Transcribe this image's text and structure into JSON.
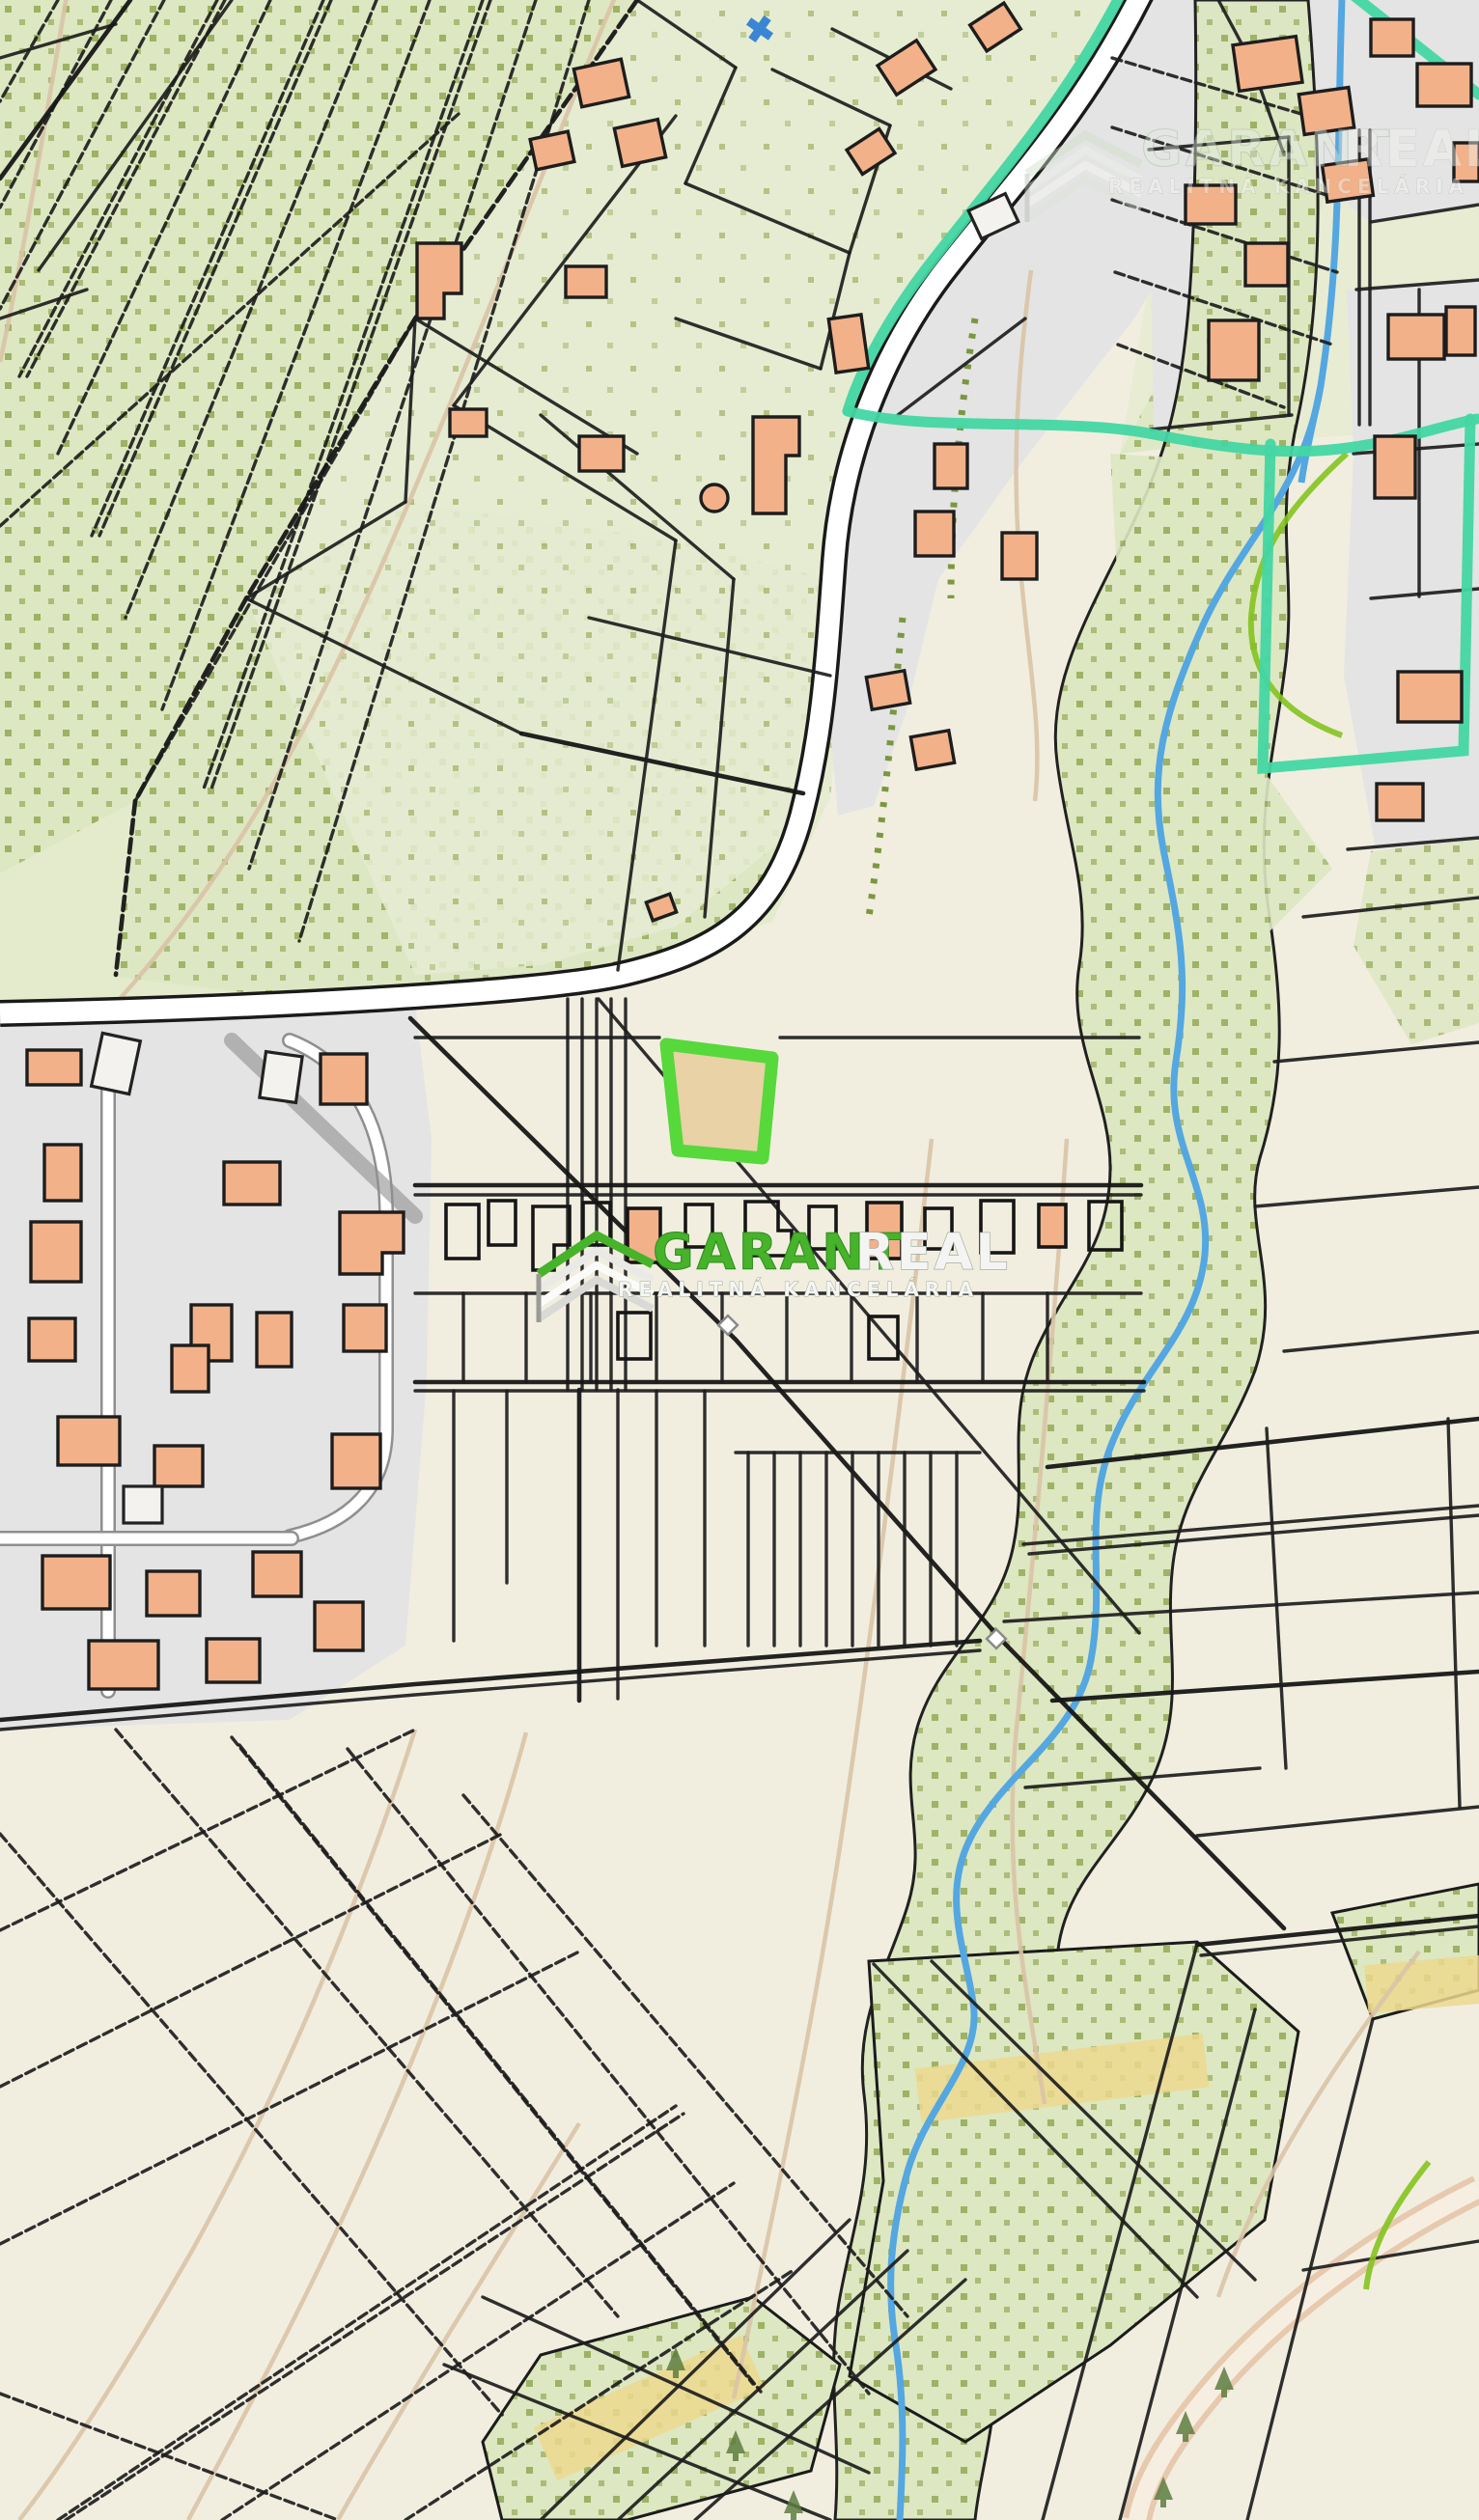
{
  "app": {
    "title": "Cadastral map with highlighted land parcel"
  },
  "watermarks": {
    "center": {
      "brand_primary": "GARANT",
      "brand_secondary": "REAL",
      "tagline": "REALITNÁ KANCELÁRIA"
    },
    "corner": {
      "brand_primary": "GARANT",
      "brand_secondary": "REAL",
      "tagline": "REALITNÁ KANCELÁRIA"
    }
  },
  "highlighted_parcel": {
    "description": "offered land parcel",
    "fill_color": "#e8d2a6",
    "outline_color": "#57d83b"
  },
  "map_colors": {
    "field_beige": "#f1eee0",
    "orchard_green": "#dde7c2",
    "orchard_dot": "#9db264",
    "urban_gray": "#e4e4e4",
    "building_fill": "#f2b189",
    "road_fill": "#ffffff",
    "road_casing": "#1a1a1a",
    "stream_blue": "#54a7e0",
    "boundary_teal": "#43d6a3",
    "contour_tan": "#d9c3a6",
    "sand_road": "#ecd88e",
    "brand_green": "#46b32a"
  },
  "map_features": [
    "orchard strip parcels top-left",
    "main road curving from top to west edge",
    "residential blocks with buildings",
    "meandering stream with riparian vegetation band",
    "teal administrative boundary",
    "highlighted parcel with bright green outline",
    "garden shed rows in field zone",
    "parcel lattice bottom area"
  ]
}
